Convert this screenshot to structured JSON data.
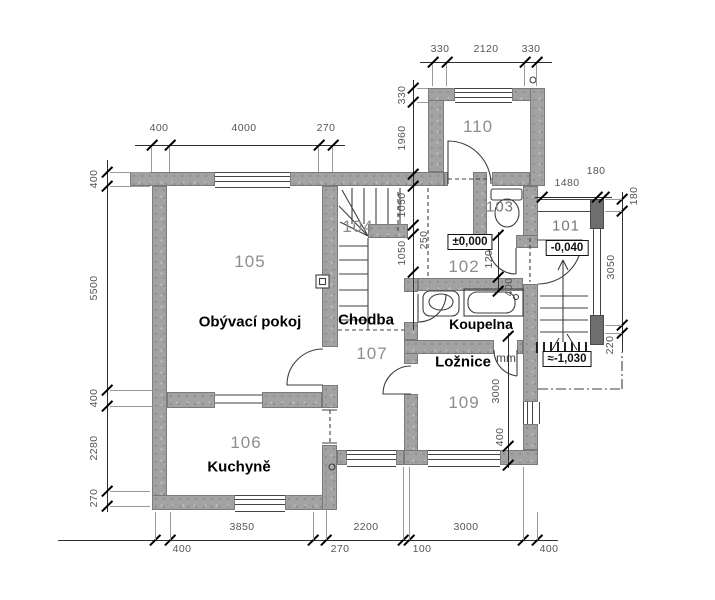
{
  "plan": {
    "rooms": {
      "living": {
        "number": "105",
        "name": "Obývací pokoj"
      },
      "kitchen": {
        "number": "106",
        "name": "Kuchyně"
      },
      "hallway": {
        "number": "107",
        "name": "Chodba"
      },
      "bedroom": {
        "number": "109",
        "name": "Ložnice"
      },
      "bathroom": {
        "name": "Koupelna"
      },
      "staircase": {
        "number": "104"
      },
      "vestibule": {
        "number": "102"
      },
      "wc": {
        "number": "103"
      },
      "porch": {
        "number": "101"
      },
      "room110": {
        "number": "110"
      }
    },
    "levels": {
      "vestibule": "±0,000",
      "porch": "-0,040",
      "terrain": "≈-1,030"
    },
    "annotations": {
      "units": "mm"
    },
    "dimensions": {
      "wing_top": [
        "330",
        "2120",
        "330"
      ],
      "main_top": [
        "400",
        "4000",
        "270"
      ],
      "left": [
        "400",
        "5500",
        "400",
        "2280",
        "270"
      ],
      "inner_left": [
        "330",
        "1960",
        "1050",
        "250",
        "1050"
      ],
      "wc_col": [
        "1200",
        "400"
      ],
      "bedroom_col": [
        "3000",
        "400"
      ],
      "porch_top": [
        "1480",
        "180"
      ],
      "right": [
        "180",
        "3050",
        "220"
      ],
      "bottom": [
        "400",
        "3850",
        "270",
        "2200",
        "100",
        "3000",
        "400"
      ]
    }
  }
}
